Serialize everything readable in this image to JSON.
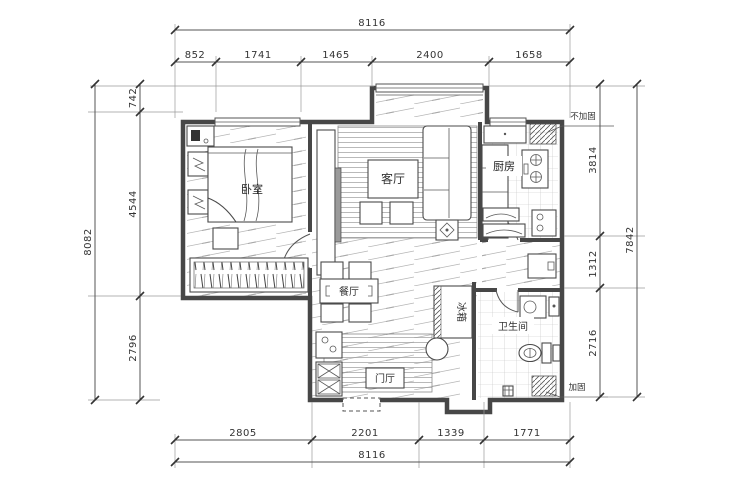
{
  "drawing": {
    "type": "apartment-floor-plan"
  },
  "dims": {
    "top": {
      "total": "8116",
      "seg": [
        "852",
        "1741",
        "1465",
        "2400",
        "1658"
      ]
    },
    "bottom": {
      "total": "8116",
      "seg": [
        "2805",
        "2201",
        "1339",
        "1771"
      ]
    },
    "left": {
      "total": "8082",
      "seg": [
        "742",
        "4544",
        "2796"
      ]
    },
    "right": {
      "total": "7842",
      "seg": [
        "3814",
        "1312",
        "2716"
      ]
    }
  },
  "rooms": {
    "bedroom": "卧室",
    "living": "客厅",
    "kitchen": "厨房",
    "dining": "餐厅",
    "bathroom": "卫生间",
    "foyer": "门厅",
    "fridge": "冰箱"
  },
  "notes": {
    "no_reinforce": "不加固",
    "reinforce": "加固"
  },
  "colors": {
    "line": "#474747",
    "hatch": "#b5b5b5",
    "tile": "#c2c2c2",
    "dim_text": "#333333",
    "bg": "#ffffff"
  }
}
